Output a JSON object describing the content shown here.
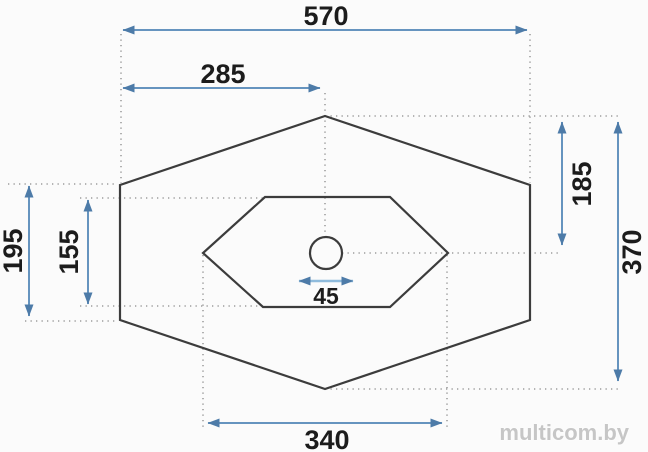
{
  "drawing": {
    "dimensions": {
      "overall_width": "570",
      "half_width": "285",
      "top_to_center": "185",
      "overall_height": "370",
      "side_edge_height": "195",
      "basin_height": "155",
      "drain_width": "45",
      "basin_width": "340"
    },
    "colors": {
      "dimension_blue": "#6694bf",
      "dimension_blue_light": "#8fbbdc",
      "arrowhead_blue": "#4d7ba8",
      "outline_dark": "#3c3c3c",
      "extension_gray": "#9d9d9d",
      "label_black": "#1c1c1c",
      "watermark_gray": "#c6c6c6"
    },
    "watermark": {
      "text": "multicom.by"
    }
  }
}
